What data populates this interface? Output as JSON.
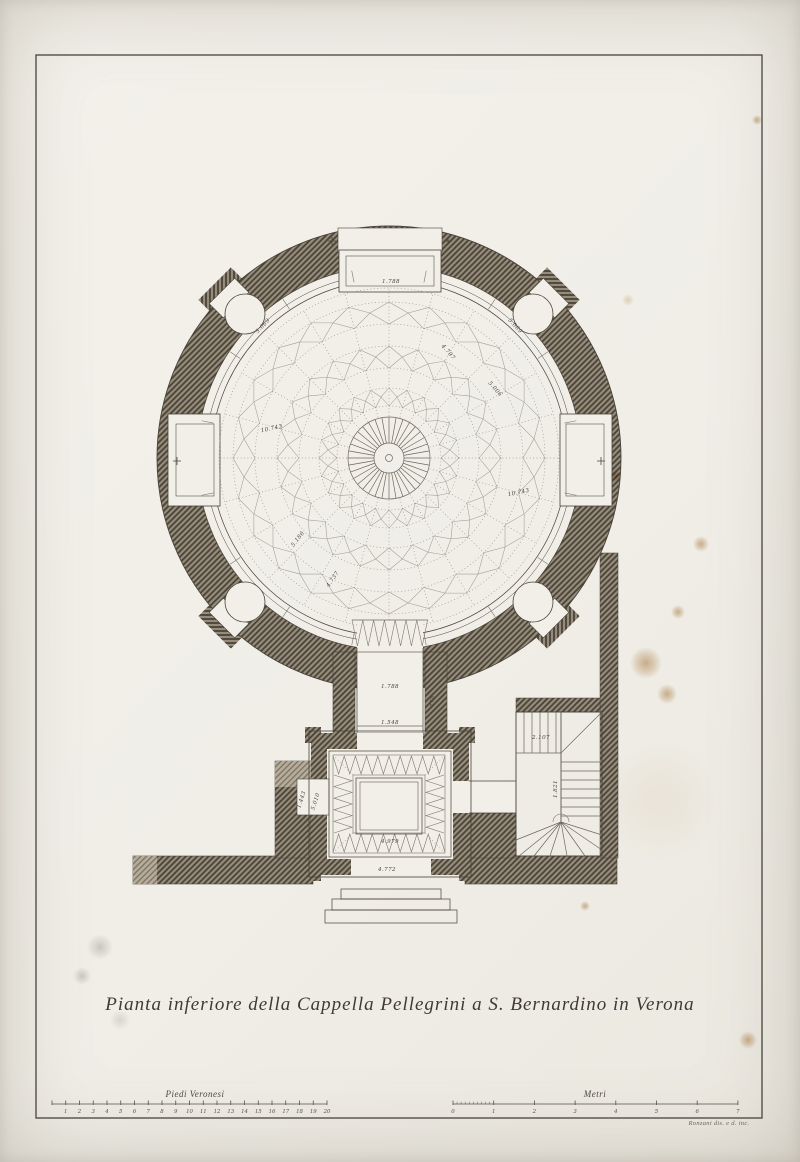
{
  "plate": {
    "title": "Pianta inferiore della Cappella Pellegrini a S. Bernardino in Verona",
    "signature": "Ronzani dis. e d. inc."
  },
  "scale_bars": {
    "left": {
      "label": "Piedi Veronesi",
      "numbers": [
        "1",
        "2",
        "3",
        "4",
        "5",
        "6",
        "7",
        "8",
        "9",
        "10",
        "11",
        "12",
        "13",
        "14",
        "15",
        "16",
        "17",
        "18",
        "19",
        "20"
      ]
    },
    "right": {
      "label": "Metri",
      "numbers": [
        "0",
        "1",
        "2",
        "3",
        "4",
        "5",
        "6",
        "7"
      ]
    }
  },
  "plan": {
    "annotations": [
      {
        "t": "1.788",
        "x": 391,
        "y": 283,
        "r": 0
      },
      {
        "t": "5.069",
        "x": 264,
        "y": 327,
        "r": -47
      },
      {
        "t": "5.069",
        "x": 514,
        "y": 327,
        "r": 47
      },
      {
        "t": "4.797",
        "x": 447,
        "y": 353,
        "r": 50
      },
      {
        "t": "5.006",
        "x": 494,
        "y": 390,
        "r": 48
      },
      {
        "t": "10.743",
        "x": 272,
        "y": 430,
        "r": -12
      },
      {
        "t": "10.743",
        "x": 519,
        "y": 494,
        "r": -12
      },
      {
        "t": "5.186",
        "x": 299,
        "y": 540,
        "r": -52
      },
      {
        "t": "4.737",
        "x": 334,
        "y": 580,
        "r": -55
      },
      {
        "t": "1.788",
        "x": 390,
        "y": 688,
        "r": 0
      },
      {
        "t": "1.548",
        "x": 390,
        "y": 724,
        "r": 0
      },
      {
        "t": "778",
        "x": 434,
        "y": 701,
        "r": -90
      },
      {
        "t": "1.443",
        "x": 303,
        "y": 800,
        "r": -72
      },
      {
        "t": "5.010",
        "x": 317,
        "y": 802,
        "r": -72
      },
      {
        "t": "4.979",
        "x": 390,
        "y": 843,
        "r": 0
      },
      {
        "t": "4.772",
        "x": 387,
        "y": 871,
        "r": 0
      },
      {
        "t": "2.107",
        "x": 541,
        "y": 739,
        "r": 0
      },
      {
        "t": "1.821",
        "x": 557,
        "y": 789,
        "r": -90
      }
    ]
  }
}
